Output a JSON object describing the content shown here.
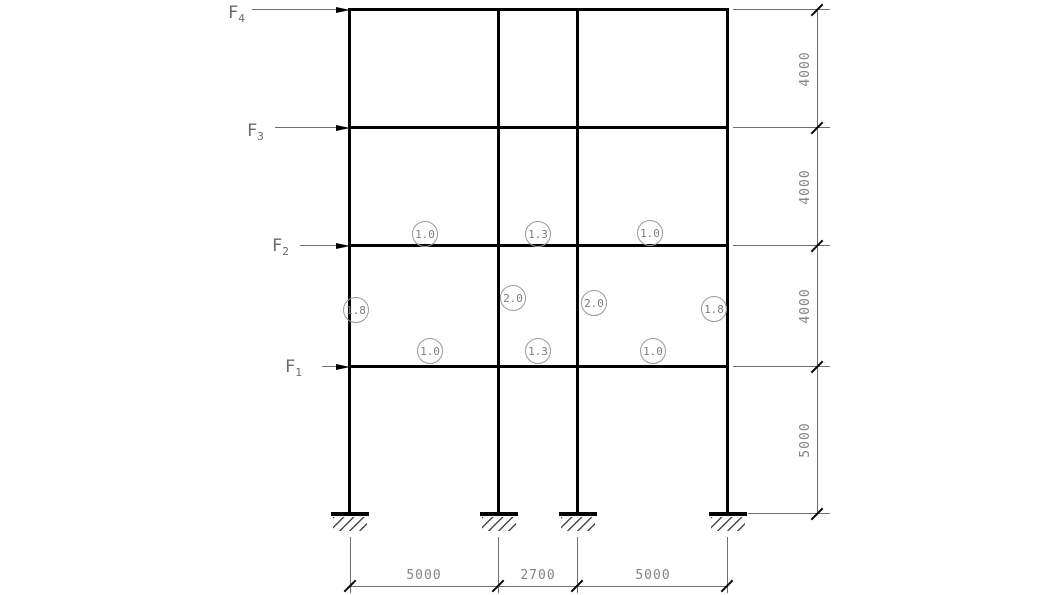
{
  "forces": [
    {
      "symbol": "F",
      "subscript": "4"
    },
    {
      "symbol": "F",
      "subscript": "3"
    },
    {
      "symbol": "F",
      "subscript": "2"
    },
    {
      "symbol": "F",
      "subscript": "1"
    }
  ],
  "coefficients": {
    "beams_level2": [
      "1.0",
      "1.3",
      "1.0"
    ],
    "columns_story2": [
      "1.8",
      "2.0",
      "2.0",
      "1.8"
    ],
    "beams_level1": [
      "1.0",
      "1.3",
      "1.0"
    ]
  },
  "dimensions": {
    "right": [
      "4000",
      "4000",
      "4000",
      "5000"
    ],
    "bottom": [
      "5000",
      "2700",
      "5000"
    ]
  },
  "colors": {
    "frame_line": "#000000",
    "thin_line": "#6e6e6e",
    "text": "#848484"
  }
}
